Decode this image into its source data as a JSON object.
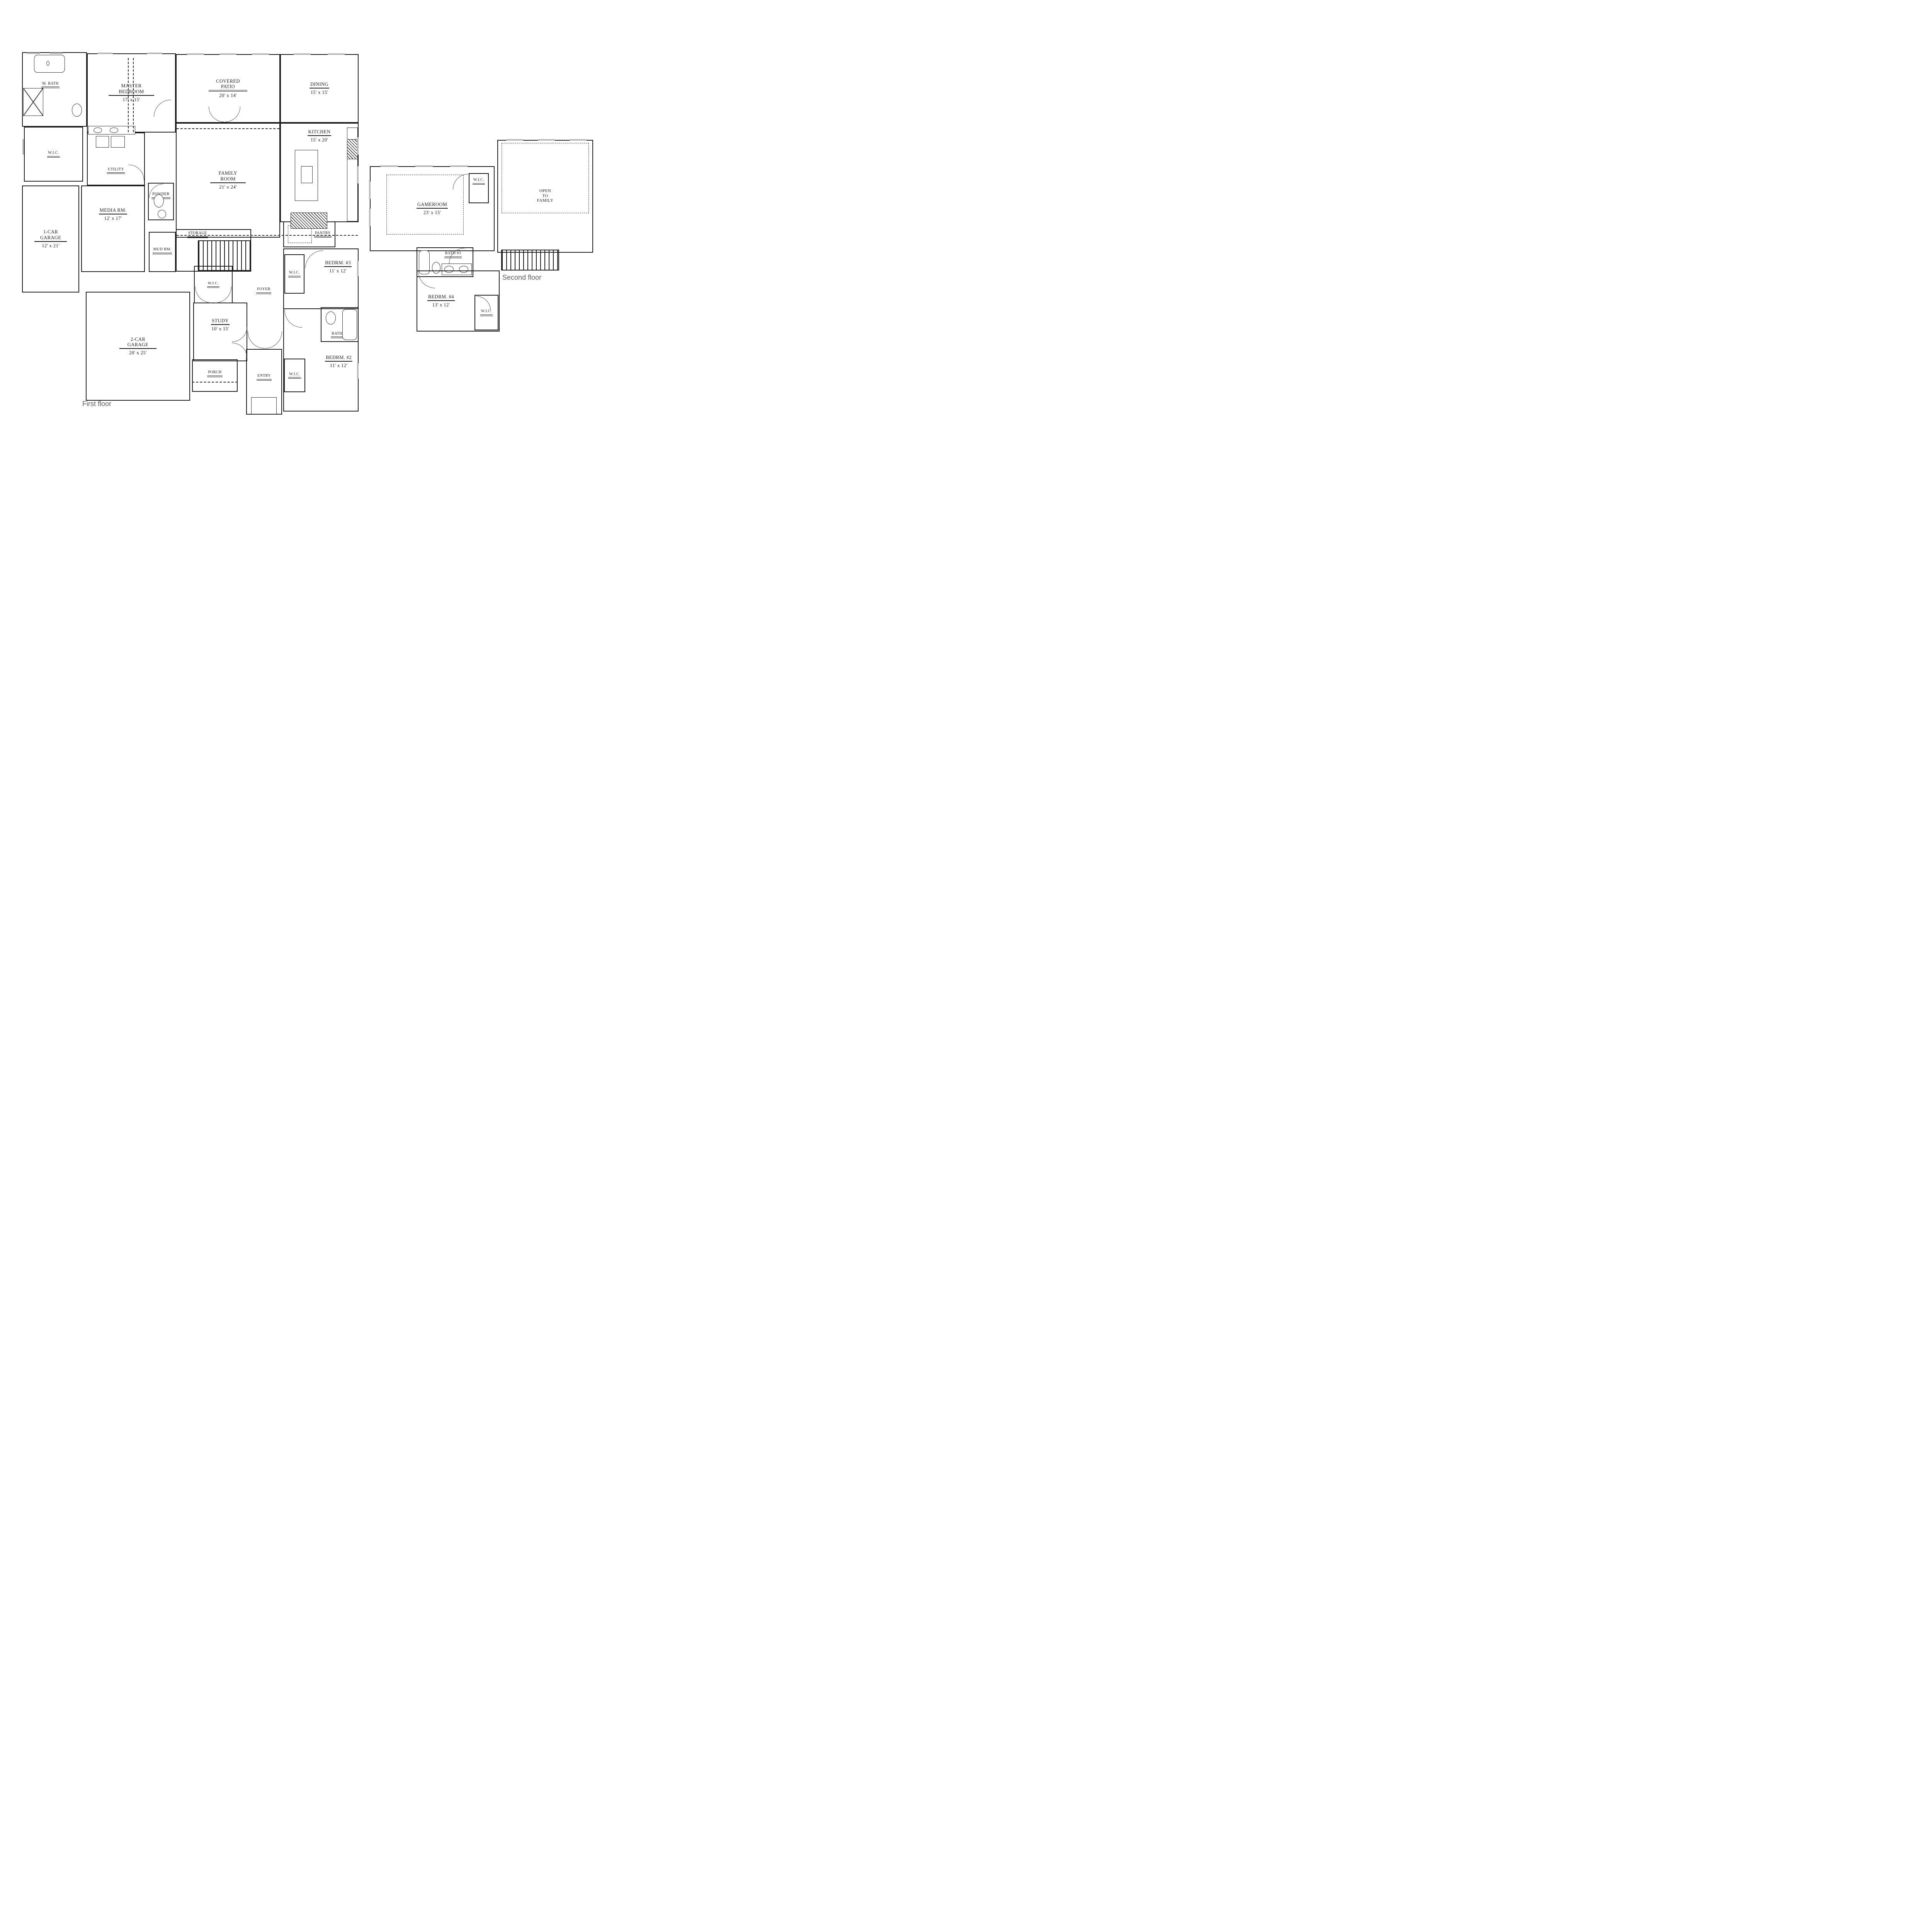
{
  "title": "Two-story house floor plan",
  "colors": {
    "wall": "#1b1b1b",
    "floor_label_gray": "#5b6064",
    "window_gray": "#b9b9b9"
  },
  "first_floor": {
    "floor_label": "First floor",
    "rooms": {
      "m_bath": {
        "name": "M. BATH"
      },
      "master_bedroom": {
        "name": "MASTER BEDROOM",
        "dim": "17' x 15'"
      },
      "covered_patio": {
        "name": "COVERED PATIO",
        "dim": "20' x 14'"
      },
      "dining": {
        "name": "DINING",
        "dim": "15' x 15'"
      },
      "kitchen": {
        "name": "KITCHEN",
        "dim": "15' x 20'"
      },
      "wic_master": {
        "name": "W.I.C."
      },
      "utility": {
        "name": "UTILITY"
      },
      "family_room": {
        "name": "FAMILY ROOM",
        "dim": "21' x 24'"
      },
      "powder": {
        "name": "POWDER"
      },
      "media_room": {
        "name": "MEDIA RM.",
        "dim": "12' x 17'"
      },
      "one_car_garage": {
        "name": "1-CAR GARAGE",
        "dim": "12' x 21'"
      },
      "storage": {
        "name": "STORAGE"
      },
      "mud_room": {
        "name": "MUD RM."
      },
      "pantry": {
        "name": "PANTRY"
      },
      "wic_bed3": {
        "name": "W.I.C."
      },
      "bedroom3": {
        "name": "BEDRM. #3",
        "dim": "11' x 12'"
      },
      "wic_hall": {
        "name": "W.I.C."
      },
      "foyer": {
        "name": "FOYER"
      },
      "two_car_garage": {
        "name": "2-CAR GARAGE",
        "dim": "20' x 25'"
      },
      "study": {
        "name": "STUDY",
        "dim": "10' x 15'"
      },
      "porch": {
        "name": "PORCH"
      },
      "entry": {
        "name": "ENTRY"
      },
      "wic_bed2": {
        "name": "W.I.C."
      },
      "bedroom2": {
        "name": "BEDRM. #2",
        "dim": "11' x 12'"
      },
      "bath2": {
        "name": "BATH #2"
      }
    }
  },
  "second_floor": {
    "floor_label": "Second floor",
    "rooms": {
      "gameroom": {
        "name": "GAMEROOM",
        "dim": "23' x 15'"
      },
      "wic_gameroom": {
        "name": "W.I.C."
      },
      "open_to_family": {
        "name": "OPEN\nTO\nFAMILY"
      },
      "bath3": {
        "name": "BATH #3"
      },
      "bedroom4": {
        "name": "BEDRM. #4",
        "dim": "13' x 12'"
      },
      "wic_bed4": {
        "name": "W.I.C."
      }
    }
  }
}
